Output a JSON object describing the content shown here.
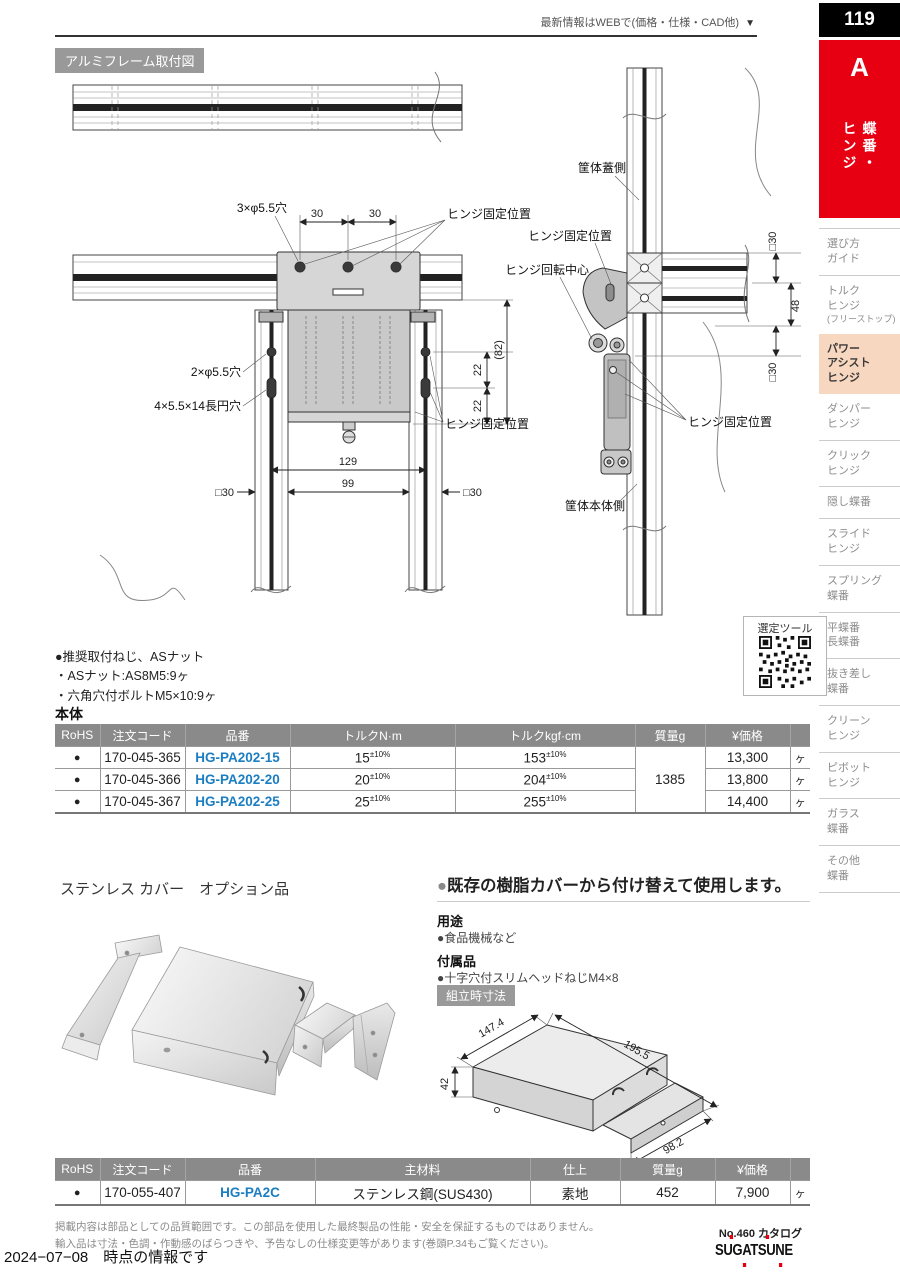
{
  "header": {
    "web_note": "最新情報はWEBで(価格・仕様・CAD他)",
    "arrow": "▼",
    "page_number": "119",
    "tab_letter": "A",
    "tab_vertical": "蝶番・\nヒンジ"
  },
  "sidebar": {
    "items": [
      {
        "label": "選び方\nガイド"
      },
      {
        "label": "トルク\nヒンジ",
        "sub": "(フリーストップ)"
      },
      {
        "label": "パワー\nアシスト\nヒンジ"
      },
      {
        "label": "ダンパー\nヒンジ"
      },
      {
        "label": "クリック\nヒンジ"
      },
      {
        "label": "隠し蝶番"
      },
      {
        "label": "スライド\nヒンジ"
      },
      {
        "label": "スプリング\n蝶番"
      },
      {
        "label": "平蝶番\n長蝶番"
      },
      {
        "label": "抜き差し\n蝶番"
      },
      {
        "label": "クリーン\nヒンジ"
      },
      {
        "label": "ピボット\nヒンジ"
      },
      {
        "label": "ガラス\n蝶番"
      },
      {
        "label": "その他\n蝶番"
      }
    ]
  },
  "diagram": {
    "title": "アルミフレーム取付図",
    "front": {
      "hole3": "3×φ5.5穴",
      "dim30a": "30",
      "dim30b": "30",
      "hinge_fix_top": "ヒンジ固定位置",
      "hole2": "2×φ5.5穴",
      "slot": "4×5.5×14長円穴",
      "dim82": "(82)",
      "dim22a": "22",
      "dim22b": "22",
      "hinge_fix_side": "ヒンジ固定位置",
      "dim129": "129",
      "dim99": "99",
      "dim30l": "□30",
      "dim30r": "□30"
    },
    "side": {
      "lid_side": "筐体蓋側",
      "hinge_fix_upper": "ヒンジ固定位置",
      "rotation_center": "ヒンジ回転中心",
      "dim30t": "□30",
      "dim48": "48",
      "dim30b": "□30",
      "hinge_fix_lower": "ヒンジ固定位置",
      "body_side": "筐体本体側"
    }
  },
  "notes": {
    "title": "●推奨取付ねじ、ASナット",
    "line1": "・ASナット:AS8M5:9ヶ",
    "line2": "・六角穴付ボルトM5×10:9ヶ"
  },
  "selector_tool": {
    "label": "選定ツール"
  },
  "main_table": {
    "title": "本体",
    "headers": {
      "rohs": "RoHS",
      "code": "注文コード",
      "part": "品番",
      "torque_nm": "トルクN·m",
      "torque_kgf": "トルクkgf·cm",
      "mass": "質量g",
      "price": "¥価格"
    },
    "mass": "1385",
    "rows": [
      {
        "rohs": "●",
        "code": "170-045-365",
        "part": "HG-PA202-15",
        "nm": "15",
        "nm_tol": "±10%",
        "kgf": "153",
        "kgf_tol": "±10%",
        "price": "13,300",
        "unit": "ヶ"
      },
      {
        "rohs": "●",
        "code": "170-045-366",
        "part": "HG-PA202-20",
        "nm": "20",
        "nm_tol": "±10%",
        "kgf": "204",
        "kgf_tol": "±10%",
        "price": "13,800",
        "unit": "ヶ"
      },
      {
        "rohs": "●",
        "code": "170-045-367",
        "part": "HG-PA202-25",
        "nm": "25",
        "nm_tol": "±10%",
        "kgf": "255",
        "kgf_tol": "±10%",
        "price": "14,400",
        "unit": "ヶ"
      }
    ]
  },
  "cover_section": {
    "title": "ステンレス カバー　オプション品",
    "headline_bullet": "●",
    "headline": "既存の樹脂カバーから付け替えて使用します。",
    "use_label": "用途",
    "use_value": "●食品機械など",
    "accessory_label": "付属品",
    "accessory_value": "●十字穴付スリムヘッドねじM4×8",
    "dims_label": "組立時寸法",
    "dims": {
      "depth": "147.4",
      "length": "195.5",
      "height": "42",
      "flap": "98.2"
    }
  },
  "cover_table": {
    "headers": {
      "rohs": "RoHS",
      "code": "注文コード",
      "part": "品番",
      "material": "主材料",
      "finish": "仕上",
      "mass": "質量g",
      "price": "¥価格"
    },
    "row": {
      "rohs": "●",
      "code": "170-055-407",
      "part": "HG-PA2C",
      "material": "ステンレス鋼(SUS430)",
      "finish": "素地",
      "mass": "452",
      "price": "7,900",
      "unit": "ヶ"
    }
  },
  "footer": {
    "disclaimer1": "掲載内容は部品としての品質範囲です。この部品を使用した最終製品の性能・安全を保証するものではありません。",
    "disclaimer2": "輸入品は寸法・色調・作動感のばらつきや、予告なしの仕様変更等があります(巻頭P.34もご覧ください)。",
    "catalog_no": "No.460 カタログ",
    "brand": "SUGATSUNE",
    "date_note": "2024−07−08　時点の情報です"
  },
  "colors": {
    "accent_red": "#e60012",
    "link_blue": "#1b7ec2",
    "table_header_gray": "#8a8a8a",
    "active_nav_bg": "#f8d7c0"
  }
}
